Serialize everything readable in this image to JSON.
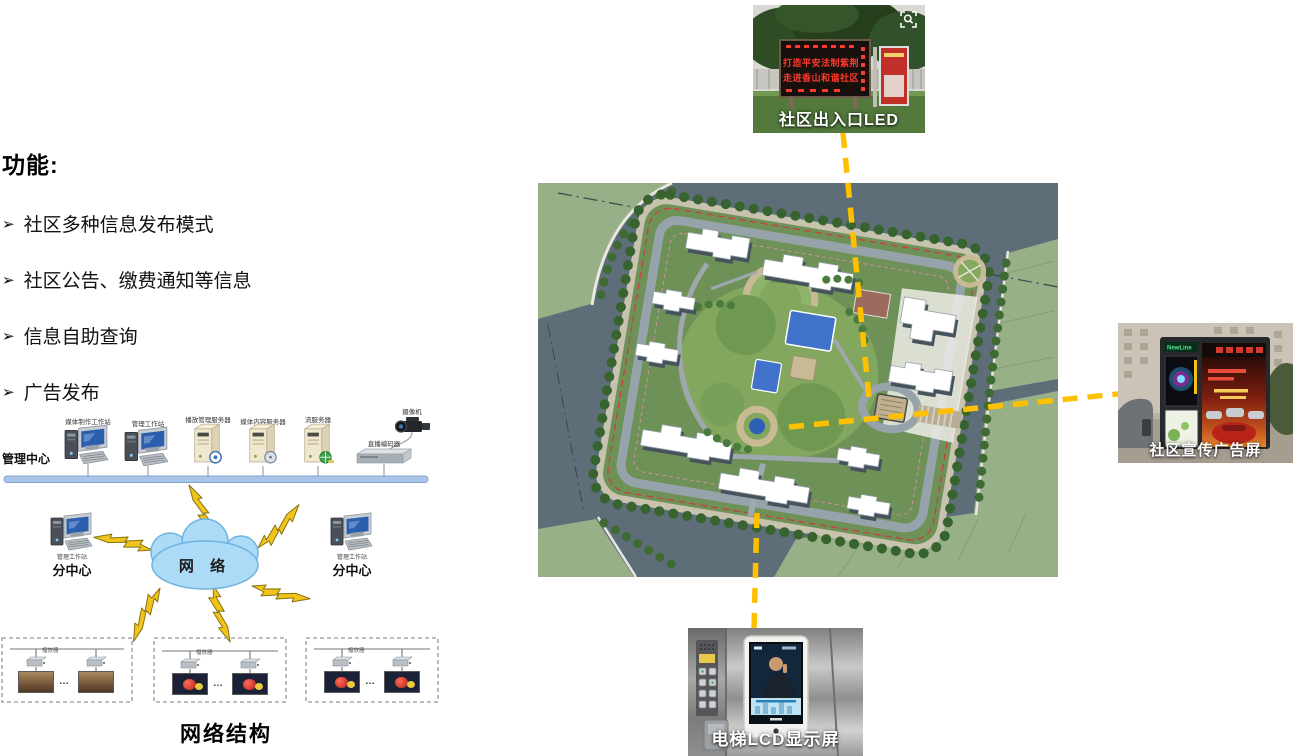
{
  "left_panel": {
    "heading": "功能:",
    "bullet_marker": "➢",
    "bullets": [
      "社区多种信息发布模式",
      "社区公告、缴费通知等信息",
      "信息自助查询",
      "广告发布"
    ]
  },
  "network_diagram": {
    "title": "网络结构",
    "management_center_label": "管理中心",
    "device_labels": [
      "媒体制作工作站",
      "管理工作站",
      "播放管理服务器",
      "媒体内容服务器",
      "流服务器"
    ],
    "camera_label": "摄像机",
    "encoder_label": "直播编码器",
    "cloud_label": "网 络",
    "subcenter_workstation_label": "管理工作站",
    "subcenter_label": "分中心",
    "player_label": "播放器",
    "ellipsis": "…"
  },
  "photos": {
    "led": {
      "caption": "社区出入口LED",
      "line1": "打造平安法制紫荆",
      "line2": "走进香山和谐社区"
    },
    "ad": {
      "caption": "社区宣传广告屏",
      "brand": "NewLine"
    },
    "elevator": {
      "caption": "电梯LCD显示屏"
    }
  },
  "colors": {
    "connector": "#FFC000",
    "bus": "#A9C6E8",
    "cloud": "#ABDBF6",
    "bolt": "#F2C31B",
    "ledred": "#FF3A2E",
    "road": "#5E6E79",
    "lawn": "#98B087",
    "site": "#6E9158",
    "pool": "#3F72C8",
    "redline": "#C94040"
  }
}
